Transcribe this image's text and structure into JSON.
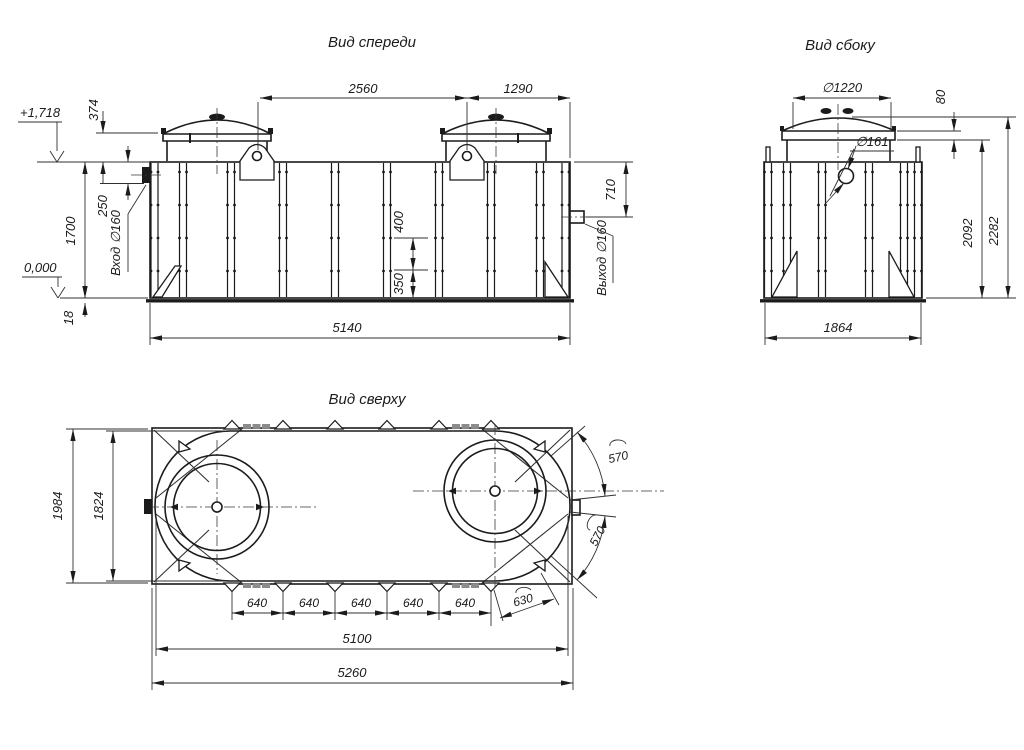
{
  "drawing": {
    "front_view": {
      "title": "Вид спереди",
      "dims": {
        "d2560": "2560",
        "d1290": "1290",
        "d374": "374",
        "level_top": "+1,718",
        "d250": "250",
        "inlet_label": "Вход ∅160",
        "d1700": "1700",
        "level_zero": "0,000",
        "d18": "18",
        "d400": "400",
        "d350": "350",
        "d710": "710",
        "outlet_label": "Выход ∅160",
        "d5140": "5140"
      }
    },
    "side_view": {
      "title": "Вид сбоку",
      "dims": {
        "d1220": "∅1220",
        "d80": "80",
        "d161": "∅161",
        "d2092": "2092",
        "d2282": "2282",
        "d1864": "1864"
      }
    },
    "top_view": {
      "title": "Вид сверху",
      "dims": {
        "d1984": "1984",
        "d1824": "1824",
        "segments": [
          "640",
          "640",
          "640",
          "640",
          "640"
        ],
        "d630": "630",
        "d570_upper": "570",
        "d570_lower": "570",
        "d5100": "5100",
        "d5260": "5260"
      }
    },
    "colors": {
      "line": "#1b1b1b",
      "background": "#ffffff"
    }
  }
}
